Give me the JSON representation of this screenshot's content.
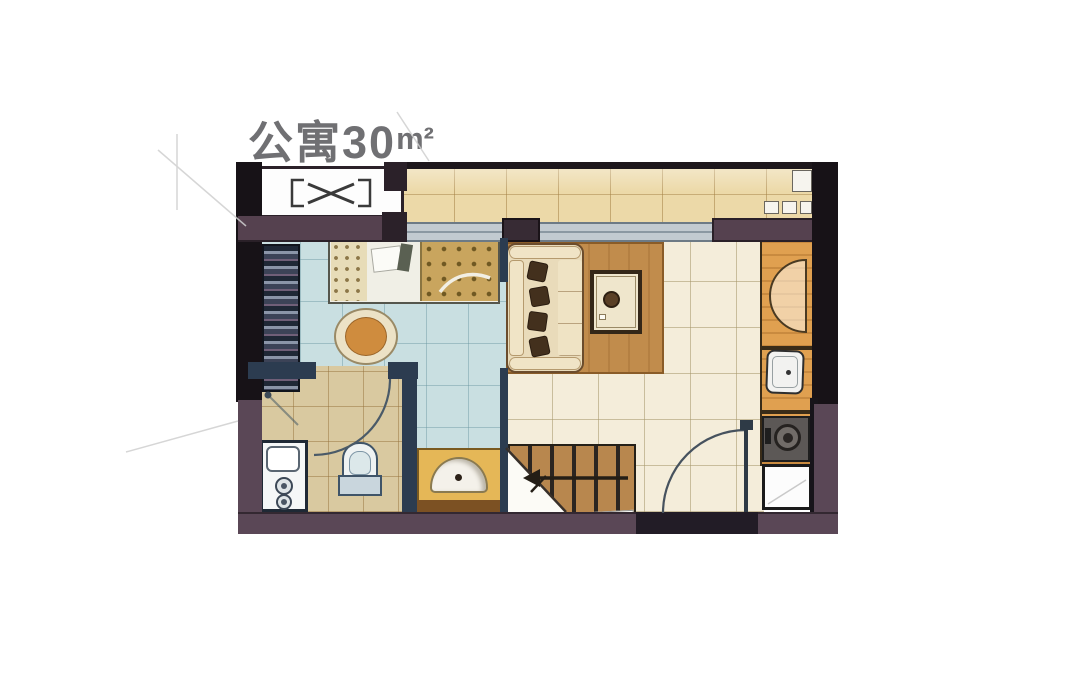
{
  "title": {
    "text": "公寓30",
    "unit_symbol": "m²",
    "color": "#707073"
  },
  "palette": {
    "wall-black": "#171217",
    "wall-purple": "#5a4756",
    "partition-navy": "#2c3c50",
    "balcony-floor": "#ecd9a8",
    "bedroom-floor": "#c9dfe1",
    "bathroom-floor": "#d9c9a0",
    "living-floor": "#f4edda",
    "window-glass": "#c2cad0",
    "rug-wood": "#c18c4c",
    "stairs-wood": "#b8874e",
    "vanity-counter": "#e5b757",
    "kitchen-counter": "#e0a050",
    "sofa-cream": "#e9dbba",
    "blanket-gold": "#c9a55e",
    "chair-orange": "#cf8c3e"
  },
  "legend": [
    "air-conditioner-platform",
    "balcony",
    "bedroom",
    "living-room",
    "bathroom",
    "kitchen-counter",
    "stairs",
    "entrance-door",
    "wardrobe",
    "bed",
    "armchair",
    "sofa",
    "coffee-table",
    "toilet",
    "washbasin-vanity",
    "washing-machine",
    "kitchen-sink",
    "stove",
    "refrigerator",
    "shower",
    "windows"
  ]
}
